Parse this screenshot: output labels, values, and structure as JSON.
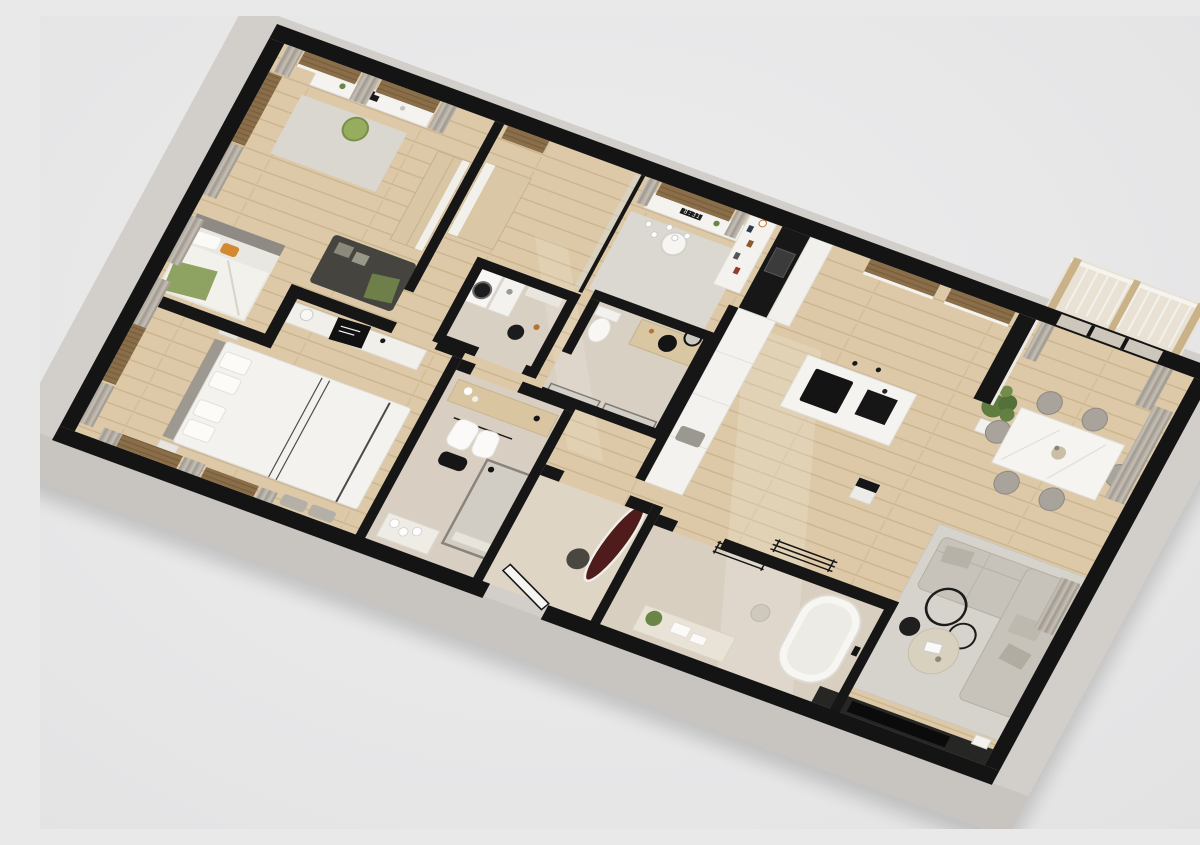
{
  "scene": {
    "type": "3d-floorplan-render",
    "view": "isometric top-down, plan rotated ~20 degrees",
    "subject": "modern apartment with cut-away black wall tops and concrete outer faces"
  },
  "clock": {
    "time": "8:31"
  },
  "palette": {
    "background": "#e9e9ea",
    "wall_top": "#141414",
    "wall_outer_face": "#d2cfcb",
    "floor_wood": "#ddc9a7",
    "floor_stone": "#d9cfc2",
    "blind_brown": "#8a6e49",
    "curtain_gray": "#b6b0a6",
    "sofa_gray": "#c8c3ba",
    "accent_green_chair": "#96ad5e",
    "accent_orange_pillow": "#d2892f",
    "accent_surfboard": "#4f1b1b",
    "plant_green": "#5f7d3f",
    "wood_furniture": "#d9c6a2"
  },
  "rooms": [
    {
      "name": "kids-bedroom",
      "furniture": [
        "desk with monitor",
        "green swivel chair",
        "dark daybed with pillows",
        "single bed with green bedding and orange pillow",
        "wood wardrobe",
        "curtains and roller blinds"
      ]
    },
    {
      "name": "home-office",
      "furniture": [
        "floating desk",
        "monitor showing 8:31",
        "white shell chair",
        "white bookshelf",
        "globe chandelier",
        "gray rug",
        "glass partition"
      ]
    },
    {
      "name": "kitchen",
      "furniture": [
        "black oven column",
        "white tall cabinets",
        "black half wall with long counter",
        "island with black cooktop and sink",
        "pendant lights",
        "windows with brown blinds"
      ]
    },
    {
      "name": "dining-area",
      "furniture": [
        "white marble table",
        "six gray upholstered chairs",
        "potted palm plant",
        "balcony sliding door with curtains"
      ]
    },
    {
      "name": "living-room",
      "furniture": [
        "L-shaped gray sectional sofa",
        "round travertine coffee table",
        "black side table",
        "two black ring floor lamps",
        "large light rug",
        "black TV media wall",
        "cube side table",
        "wall coat rack"
      ]
    },
    {
      "name": "master-bedroom",
      "furniture": [
        "double bed with black trim duvet",
        "gray headboard panel",
        "long white console with black art print",
        "nightstands",
        "foot-of-bed stools",
        "curtains"
      ]
    },
    {
      "name": "walk-in-closet",
      "furniture": [
        "wood sideboard",
        "hanging white robes",
        "black duffel bag"
      ]
    },
    {
      "name": "ensuite-shower-room",
      "furniture": [
        "black framed glass shower",
        "towel shelf with rolled towels"
      ]
    },
    {
      "name": "laundry-room",
      "furniture": [
        "washer with black door",
        "dryer",
        "shelf",
        "black laundry basket"
      ]
    },
    {
      "name": "guest-wc",
      "furniture": [
        "toilet",
        "wood vanity with black round basin",
        "round black mirror",
        "glass partition"
      ]
    },
    {
      "name": "main-bathroom",
      "furniture": [
        "freestanding white bathtub",
        "vanity with towels and plant",
        "black towel ladder",
        "stool"
      ]
    },
    {
      "name": "entry-hall",
      "furniture": [
        "white front door ajar",
        "burgundy surfboard leaning on wall",
        "dark pouf"
      ]
    },
    {
      "name": "balcony",
      "furniture": [
        "white railing",
        "wood posts"
      ]
    }
  ]
}
